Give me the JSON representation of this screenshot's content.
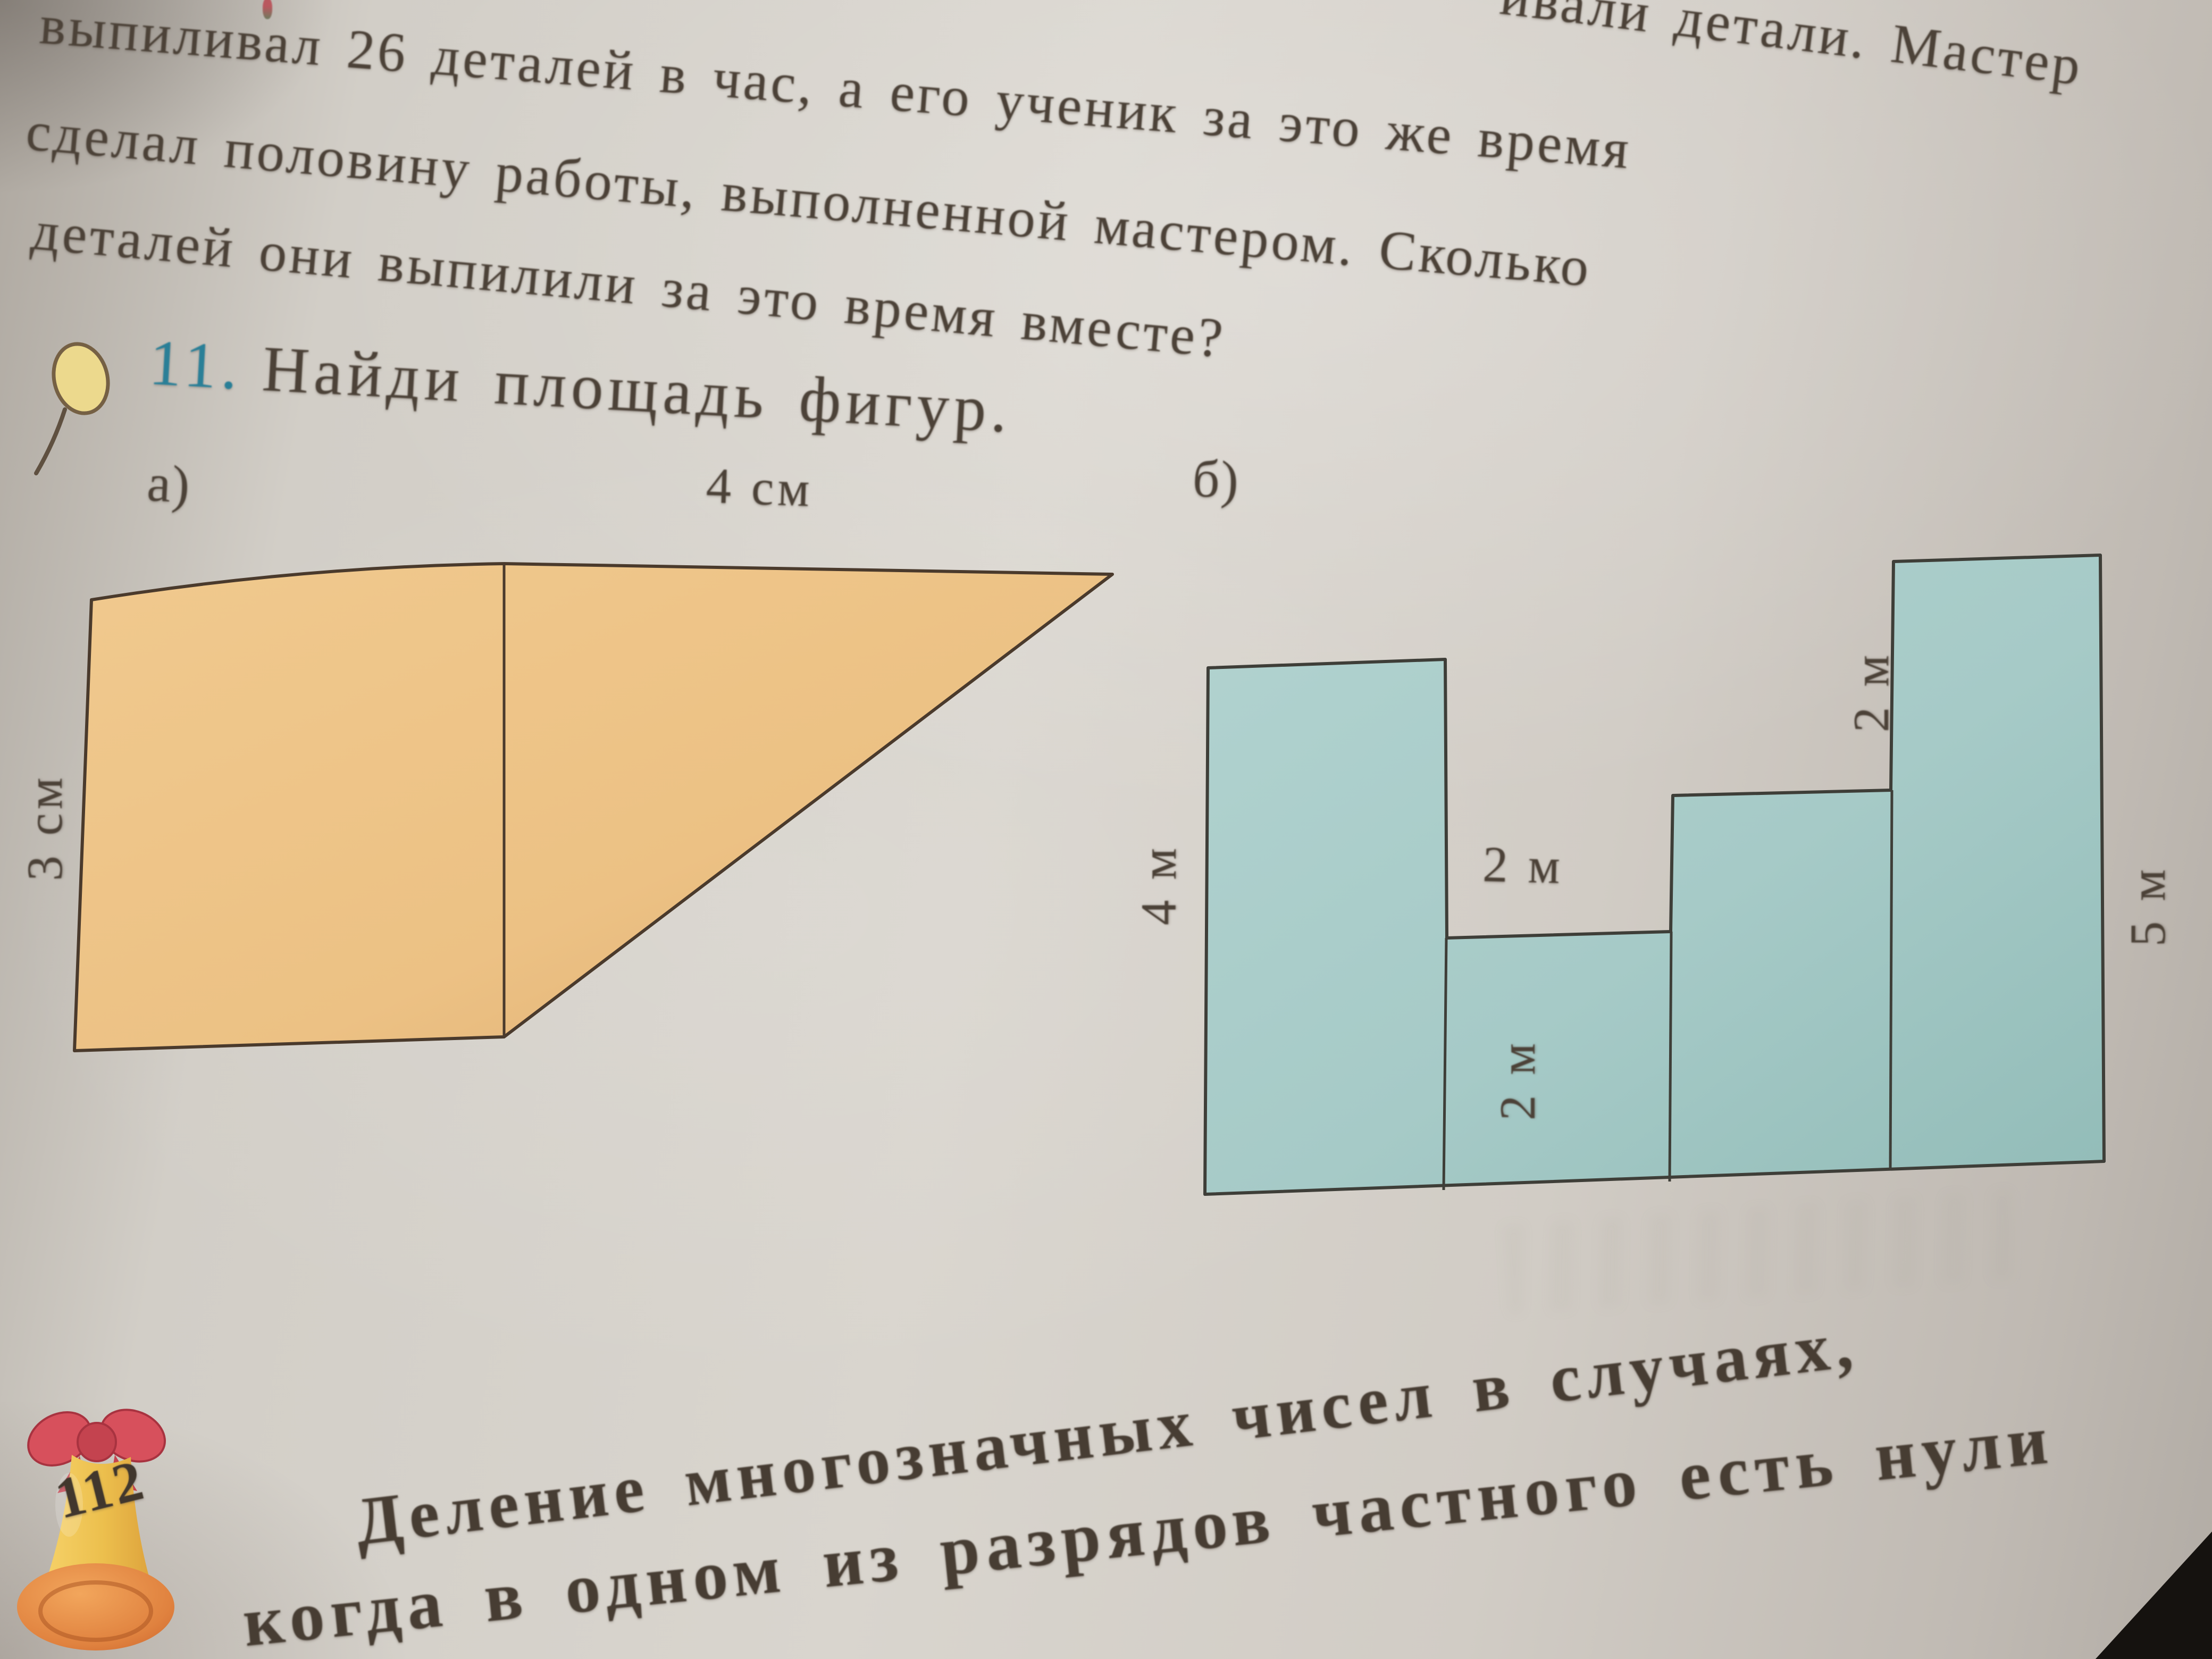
{
  "problem_tail": {
    "line0": "ивали детали. Мастер",
    "line1": "выпиливал 26 деталей в час, а его ученик за это же время",
    "line2": "сделал половину работы, выполненной мастером. Сколько",
    "line3": "деталей они выпилили за это время вместе?"
  },
  "task": {
    "number": "11.",
    "title": "Найди площадь фигур.",
    "icon": "magnifier-icon"
  },
  "figure_a": {
    "label": "а)",
    "top_label": "4 см",
    "side_label": "3 см"
  },
  "figure_b": {
    "label": "б)",
    "left_height_label": "4 м",
    "middle_width_label": "2 м",
    "middle_height_label": "2 м",
    "step_height_label": "2 м",
    "right_height_label": "5 м"
  },
  "footer": {
    "page_number": "112",
    "heading_line1": "Деление многозначных чисел в случаях,",
    "heading_line2": "когда в одном из разрядов частного есть нули"
  },
  "colors": {
    "ink": "#4c4238",
    "task_number": "#2a7f97",
    "figure_a_fill": "#ebc084",
    "figure_b_fill": "#a6cac7",
    "bell_gold": "#eebd4a",
    "bow_red": "#d7505c"
  }
}
